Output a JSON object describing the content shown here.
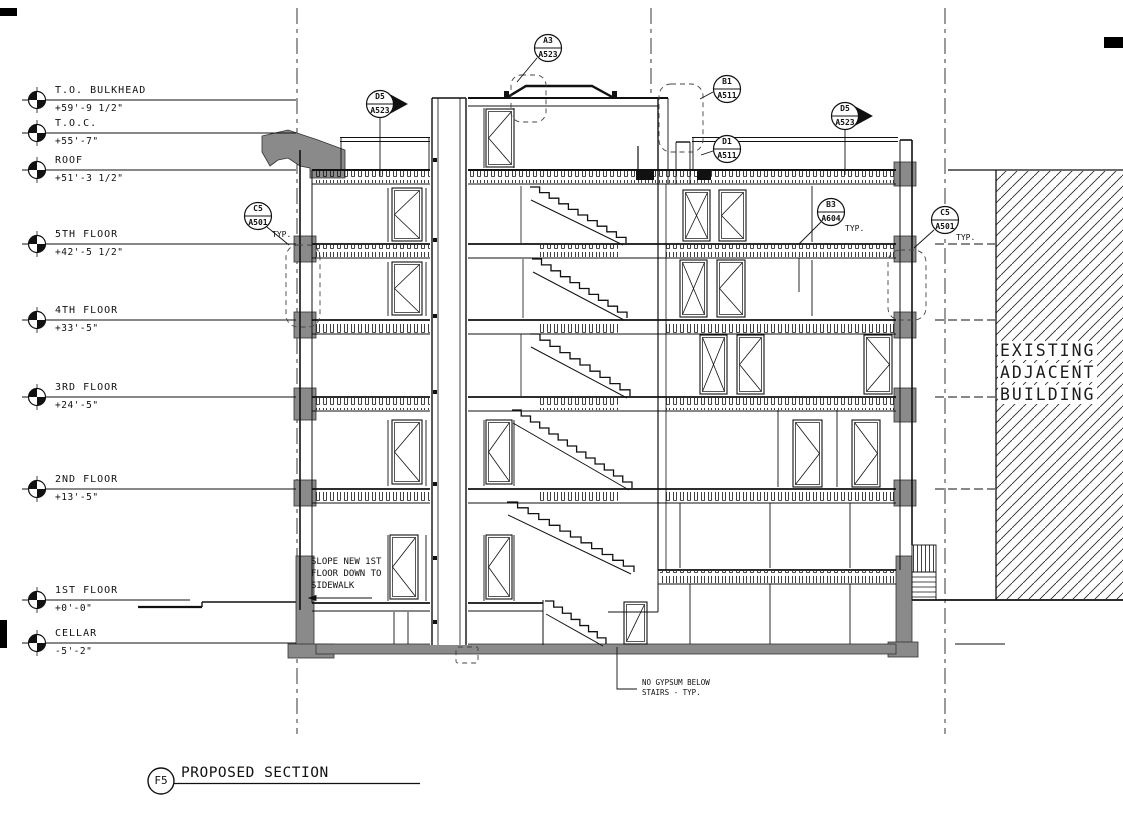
{
  "drawing_title": {
    "tag": "F5",
    "label": "PROPOSED SECTION"
  },
  "levels": [
    {
      "name": "T.O. BULKHEAD",
      "elev": "+59'-9 1/2\""
    },
    {
      "name": "T.O.C.",
      "elev": "+55'-7\""
    },
    {
      "name": "ROOF",
      "elev": "+51'-3 1/2\""
    },
    {
      "name": "5TH FLOOR",
      "elev": "+42'-5 1/2\""
    },
    {
      "name": "4TH FLOOR",
      "elev": "+33'-5\""
    },
    {
      "name": "3RD FLOOR",
      "elev": "+24'-5\""
    },
    {
      "name": "2ND FLOOR",
      "elev": "+13'-5\""
    },
    {
      "name": "1ST FLOOR",
      "elev": "+0'-0\""
    },
    {
      "name": "CELLAR",
      "elev": "-5'-2\""
    }
  ],
  "callouts": [
    {
      "detail": "A3",
      "sheet": "A523"
    },
    {
      "detail": "D5",
      "sheet": "A523"
    },
    {
      "detail": "B1",
      "sheet": "A511"
    },
    {
      "detail": "D1",
      "sheet": "A511"
    },
    {
      "detail": "D5",
      "sheet": "A523"
    },
    {
      "detail": "B3",
      "sheet": "A604",
      "typ": "TYP."
    },
    {
      "detail": "C5",
      "sheet": "A501",
      "typ": "TYP."
    },
    {
      "detail": "C5",
      "sheet": "A501",
      "typ": "TYP."
    }
  ],
  "notes": {
    "slope": [
      "SLOPE NEW 1ST",
      "FLOOR DOWN TO",
      "SIDEWALK"
    ],
    "gypsum": [
      "NO GYPSUM BELOW",
      "STAIRS - TYP."
    ],
    "existing": [
      "EXISTING",
      "ADJACENT",
      "BUILDING"
    ]
  }
}
